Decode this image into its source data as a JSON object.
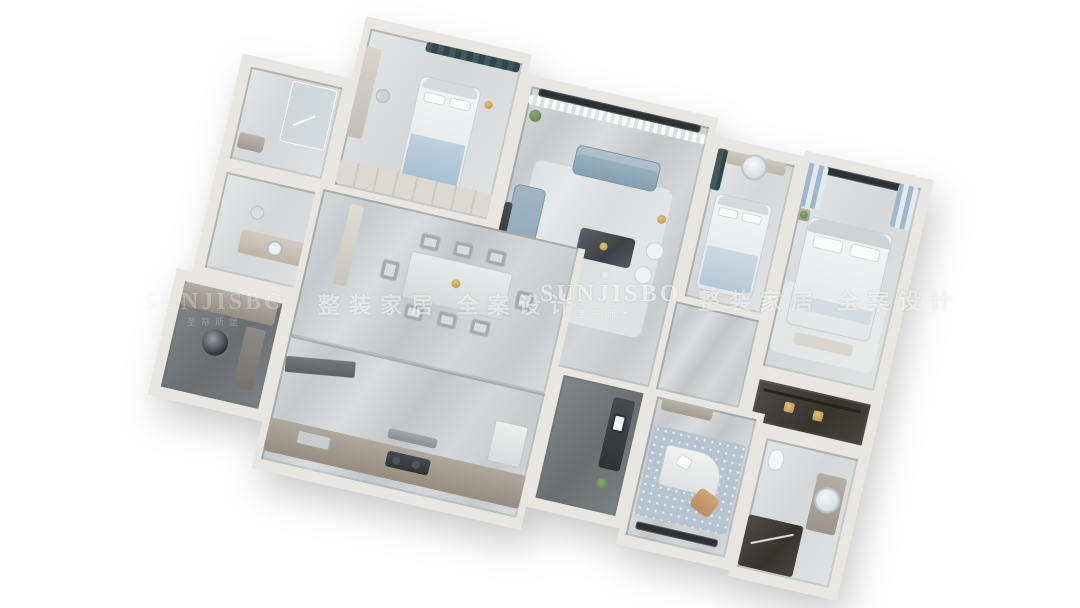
{
  "watermarks": {
    "brand": "SUNJISBO",
    "brand_sub": "圣蒂斯堡",
    "crown_icon": "✺",
    "slogan": "整装家居 全案设计"
  },
  "colors": {
    "background": "#ffffff",
    "wall": "#e7e6e3",
    "window": "#2e3134",
    "sofa": "#8fa7b7",
    "curtain_teal": "#3f585c",
    "curtain_blue": "#9db8ce",
    "wood": "#c09a6e",
    "brass": "#c9a35a",
    "rug_blue": "#b5c3d1",
    "floor_marble": "#ced1d3",
    "floor_dark": "#77797c"
  }
}
